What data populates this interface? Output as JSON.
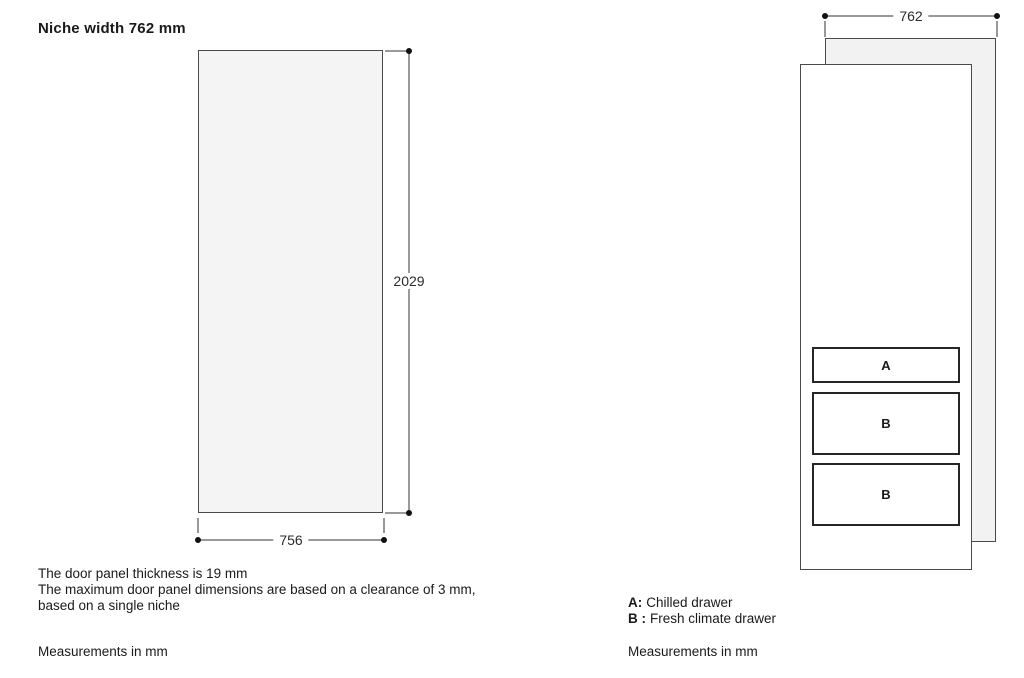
{
  "left_diagram": {
    "title": "Niche width 762 mm",
    "height_dimension": "2029",
    "width_dimension": "756",
    "notes": [
      "The door panel thickness is 19 mm",
      "The maximum door panel dimensions are based on a clearance of 3 mm,",
      "based on a single niche"
    ],
    "footer": "Measurements in mm"
  },
  "right_diagram": {
    "width_dimension": "762",
    "drawers": [
      {
        "label": "A"
      },
      {
        "label": "B"
      },
      {
        "label": "B"
      }
    ],
    "legend": [
      {
        "key": "A:",
        "label": "Chilled drawer"
      },
      {
        "key": "B :",
        "label": "Fresh climate drawer"
      }
    ],
    "footer": "Measurements in mm"
  },
  "colors": {
    "panel_fill": "#f4f4f4",
    "back_panel_fill": "#f2f2f2",
    "front_panel_fill": "#ffffff",
    "panel_border": "#4a4a4a",
    "drawer_border": "#262626",
    "dimension_line": "#999999",
    "dimension_dot": "#111111",
    "text": "#1a1a1a"
  }
}
